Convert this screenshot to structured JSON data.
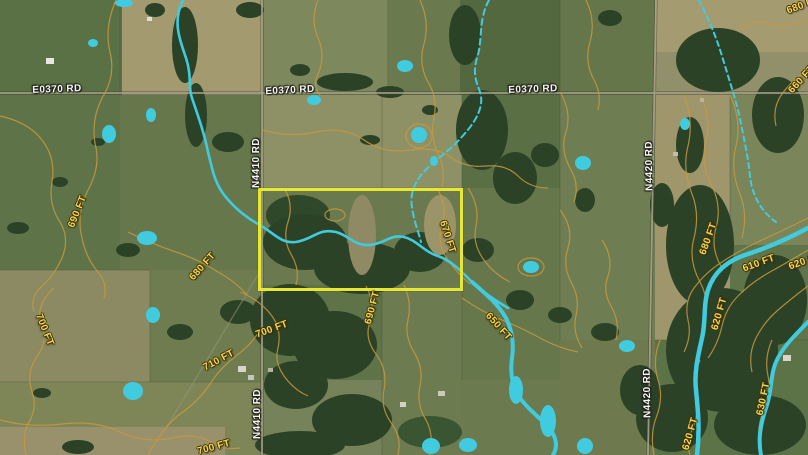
{
  "map": {
    "description": "Satellite terrain map with topographic contour overlay and highlighted parcel",
    "colors": {
      "water": "#41cbdf",
      "contour": "#c8993e",
      "selection_box": "#e8e832",
      "road_label": "#f6f5ef",
      "elevation_label": "#f2d94a"
    },
    "selection_box": {
      "x": 258,
      "y": 188,
      "width": 199,
      "height": 97
    },
    "road_labels": [
      {
        "text": "E0370 RD",
        "x": 57,
        "y": 90,
        "rotation": -2
      },
      {
        "text": "E0370 RD",
        "x": 290,
        "y": 91,
        "rotation": -3
      },
      {
        "text": "E0370 RD",
        "x": 533,
        "y": 90,
        "rotation": -2
      },
      {
        "text": "N4410 RD",
        "x": 257,
        "y": 163,
        "rotation": -90
      },
      {
        "text": "N4410 RD",
        "x": 258,
        "y": 414,
        "rotation": -90
      },
      {
        "text": "N4420 RD",
        "x": 650,
        "y": 166,
        "rotation": -91
      },
      {
        "text": "N4420 RD",
        "x": 648,
        "y": 393,
        "rotation": -91
      }
    ],
    "elevation_labels": [
      {
        "text": "690 FT",
        "x": 78,
        "y": 212,
        "rotation": -68
      },
      {
        "text": "680 FT",
        "x": 203,
        "y": 267,
        "rotation": -48
      },
      {
        "text": "700 FT",
        "x": 44,
        "y": 330,
        "rotation": 68
      },
      {
        "text": "710 FT",
        "x": 219,
        "y": 361,
        "rotation": -28
      },
      {
        "text": "700 FT",
        "x": 272,
        "y": 330,
        "rotation": -20
      },
      {
        "text": "700 FT",
        "x": 214,
        "y": 448,
        "rotation": -15
      },
      {
        "text": "670 FT",
        "x": 447,
        "y": 237,
        "rotation": 72
      },
      {
        "text": "690 FT",
        "x": 373,
        "y": 308,
        "rotation": -75
      },
      {
        "text": "650 FT",
        "x": 498,
        "y": 327,
        "rotation": 48
      },
      {
        "text": "680 FT",
        "x": 709,
        "y": 239,
        "rotation": -70
      },
      {
        "text": "610 FT",
        "x": 759,
        "y": 264,
        "rotation": -20
      },
      {
        "text": "620 FT",
        "x": 805,
        "y": 262,
        "rotation": -20
      },
      {
        "text": "620 FT",
        "x": 720,
        "y": 314,
        "rotation": -74
      },
      {
        "text": "630 FT",
        "x": 764,
        "y": 399,
        "rotation": -78
      },
      {
        "text": "620 FT",
        "x": 691,
        "y": 434,
        "rotation": -74
      },
      {
        "text": "680 FT",
        "x": 803,
        "y": 6,
        "rotation": -20
      },
      {
        "text": "660 FT",
        "x": 802,
        "y": 80,
        "rotation": -48
      }
    ]
  }
}
